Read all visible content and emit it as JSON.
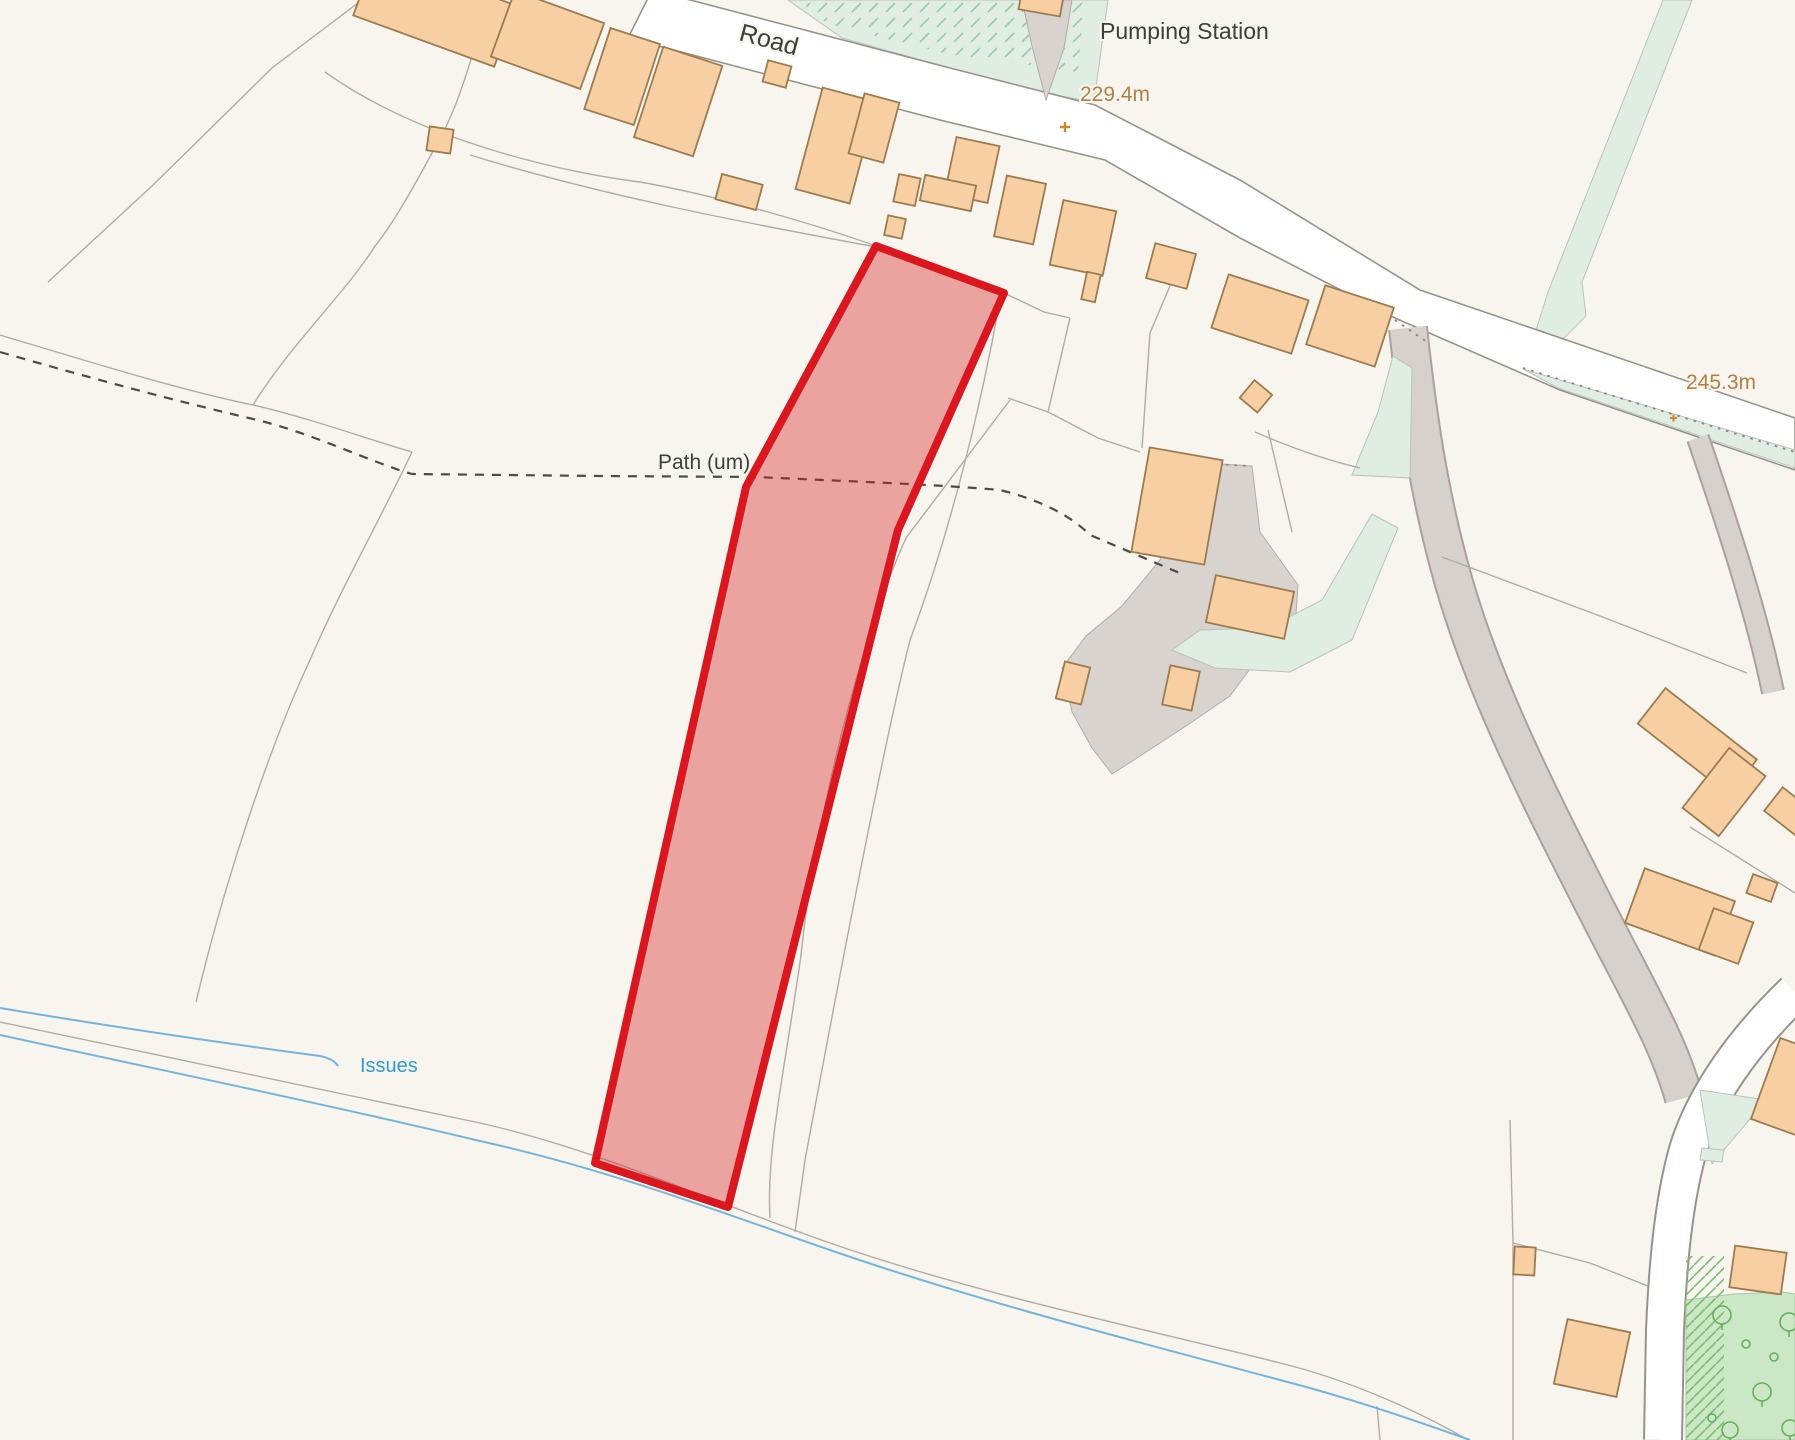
{
  "title": "Site location plan",
  "labels": {
    "road": "Road",
    "pumping_station": "Pumping Station",
    "spot_height_road": "229.4m",
    "spot_height_east": "245.3m",
    "path": "Path (um)",
    "issues": "Issues"
  },
  "site": {
    "points": "876,246 1004,293 898,530 728,1207 595,1163 746,487",
    "stroke": "#da161f",
    "fill": "rgba(214,28,32,0.38)"
  },
  "colors": {
    "background": "#f8f5ef",
    "building_fill": "#f8cfa2",
    "building_outline": "#9a7c50",
    "road_fill": "#ffffff",
    "road_casing": "#98928b",
    "track_fill": "#d6d1cc",
    "green_light": "#e0ede2",
    "green_wood": "#cbe7c5",
    "tree_outline": "#67ae62",
    "water_blue": "#74b4dc",
    "water_label_text": "#2e9bd6",
    "spot_height_text": "#b08142",
    "spot_marker": "#c9892e",
    "boundary_line": "#b2aba3",
    "path_dash": "#4e4a46",
    "label_text": "#3e3e3c"
  }
}
